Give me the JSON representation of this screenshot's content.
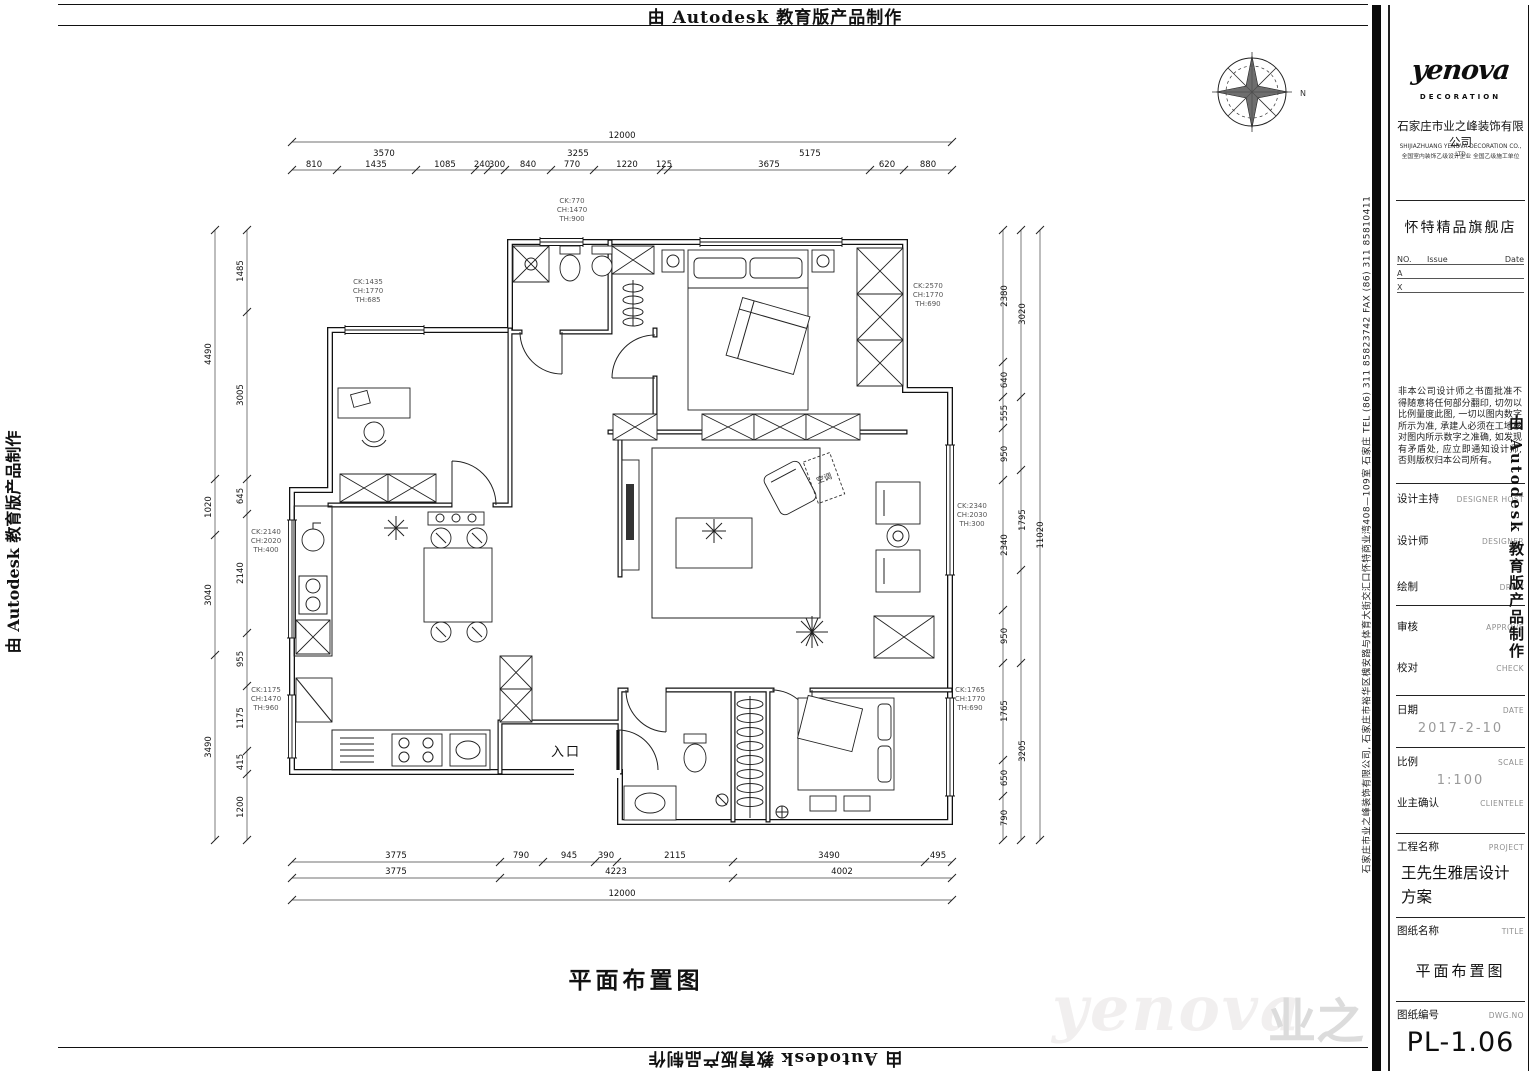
{
  "banner": {
    "text": "由 Autodesk 教育版产品制作"
  },
  "address_strip": {
    "text": "石家庄市业之峰装饰有限公司, 石家庄市裕华区槐安路与体育大街交汇口怀特商业湾408—109室   石家庄   TEL (86) 311 85823742   FAX (86) 311 85810411"
  },
  "titleblock": {
    "logo_text": "yenova",
    "logo_sub": "DECORATION",
    "company_cn": "石家庄市业之峰装饰有限公司",
    "company_en1": "SHIJIAZHUANG YENOVA DECORATION CO., LTD",
    "company_en2": "全国室内装饰乙级设计企业  全国乙级施工单位",
    "store": "怀特精品旗舰店",
    "rev": {
      "no": "NO.",
      "issue": "Issue",
      "date": "Date",
      "rows": [
        "A",
        "X"
      ]
    },
    "notice": "非本公司设计师之书面批准不得随意将任何部分翻印, 切勿以比例量度此图, 一切以图内数字所示为准, 承建人必须在工地核对图内所示数字之准确, 如发现有矛盾处, 应立即通知设计师, 否则版权归本公司所有。",
    "fields": [
      {
        "cn": "设计主持",
        "en": "DESIGNER HOST"
      },
      {
        "cn": "设计师",
        "en": "DESIGNER"
      },
      {
        "cn": "绘制",
        "en": "DRAW"
      },
      {
        "cn": "审核",
        "en": "APPROVE"
      },
      {
        "cn": "校对",
        "en": "CHECK"
      }
    ],
    "date": {
      "cn": "日期",
      "en": "DATE",
      "value": "2017-2-10"
    },
    "scale": {
      "cn": "比例",
      "en": "SCALE",
      "value": "1:100"
    },
    "client": {
      "cn": "业主确认",
      "en": "CLIENTELE"
    },
    "project": {
      "cn": "工程名称",
      "en": "PROJECT",
      "value": "王先生雅居设计方案"
    },
    "sheet": {
      "cn": "图纸名称",
      "en": "TITLE",
      "value": "平面布置图"
    },
    "dwg": {
      "cn": "图纸编号",
      "en": "DWG.NO",
      "value": "PL-1.06"
    }
  },
  "plan": {
    "caption": "平面布置图",
    "entrance_label": "入口",
    "ac_label": "空调",
    "compass_label": "N",
    "dims": {
      "top_total": "12000",
      "top_groups": [
        "3570",
        "3255",
        "5175"
      ],
      "top_segs": [
        "810",
        "1435",
        "1085",
        "240",
        "300",
        "840",
        "770",
        "1220",
        "125",
        "3675",
        "620",
        "880"
      ],
      "bottom_segs": [
        "3775",
        "790",
        "945",
        "390",
        "2115",
        "3490",
        "495"
      ],
      "bottom_groups": [
        "3775",
        "4223",
        "4002"
      ],
      "bottom_total": "12000",
      "left_segs": [
        "1485",
        "3005",
        "645",
        "2140",
        "955",
        "1175",
        "415",
        "1200"
      ],
      "left_groups": [
        "4490",
        "1020",
        "3040",
        "3490"
      ],
      "right_segs": [
        "2380",
        "640",
        "555",
        "950",
        "2340",
        "950",
        "1765",
        "650",
        "790"
      ],
      "right_groups": [
        "3020",
        "1795",
        "3205"
      ],
      "right_total": "11020"
    },
    "window_tags": [
      {
        "l1": "CK:1435",
        "l2": "CH:1770",
        "l3": "TH:685"
      },
      {
        "l1": "CK:770",
        "l2": "CH:1470",
        "l3": "TH:900"
      },
      {
        "l1": "CK:2570",
        "l2": "CH:1770",
        "l3": "TH:690"
      },
      {
        "l1": "CK:2340",
        "l2": "CH:2030",
        "l3": "TH:300"
      },
      {
        "l1": "CK:2140",
        "l2": "CH:2020",
        "l3": "TH:400"
      },
      {
        "l1": "CK:1175",
        "l2": "CH:1470",
        "l3": "TH:960"
      },
      {
        "l1": "CK:1765",
        "l2": "CH:1770",
        "l3": "TH:690"
      }
    ]
  },
  "watermark": {
    "latin": "yenova",
    "cjk": "业之"
  }
}
